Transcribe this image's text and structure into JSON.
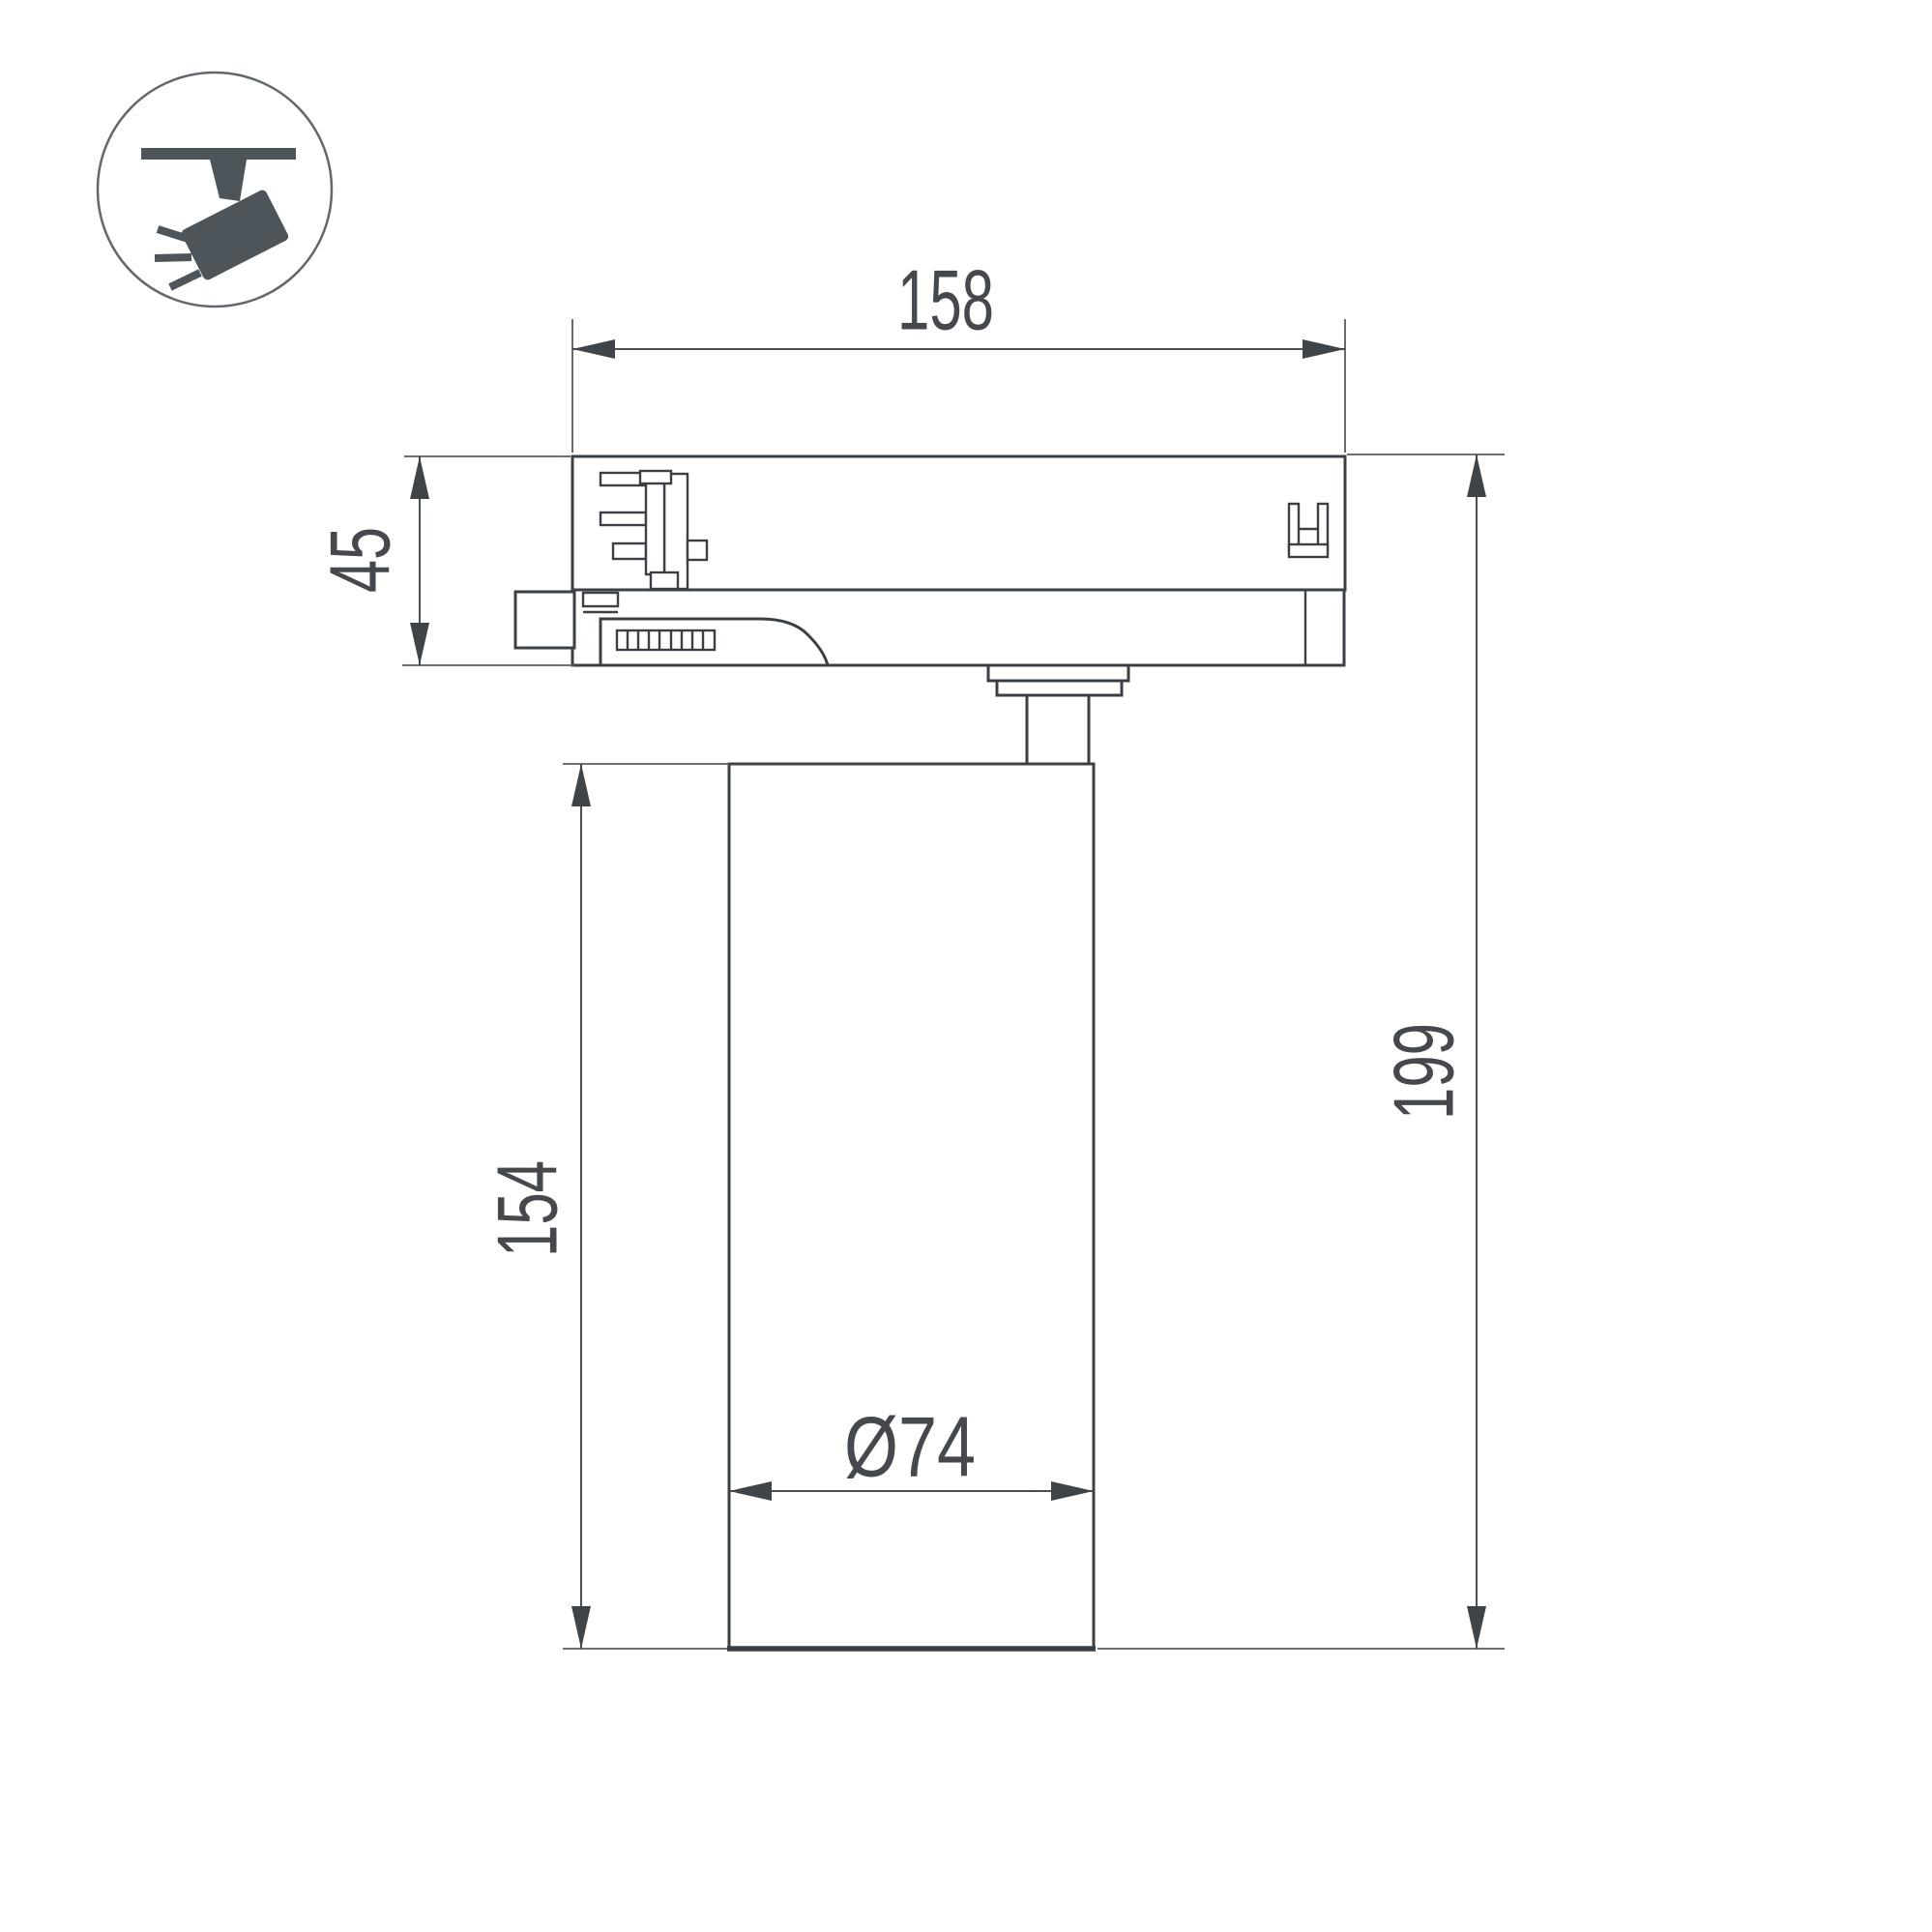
{
  "page": {
    "background": "#ffffff",
    "kind": "technical dimension drawing of track-mounted spotlight"
  },
  "colors": {
    "line": "#3b4045",
    "dim_line": "#4a4f54",
    "text": "#45494e",
    "icon": "#4d545a",
    "circle_stroke": "#62676d",
    "background": "#ffffff"
  },
  "icon": {
    "type": "track-spotlight"
  },
  "dimensions": {
    "top_width": "158",
    "adapter_height": "45",
    "body_height": "154",
    "total_height": "199",
    "body_diameter": "Ø74"
  }
}
